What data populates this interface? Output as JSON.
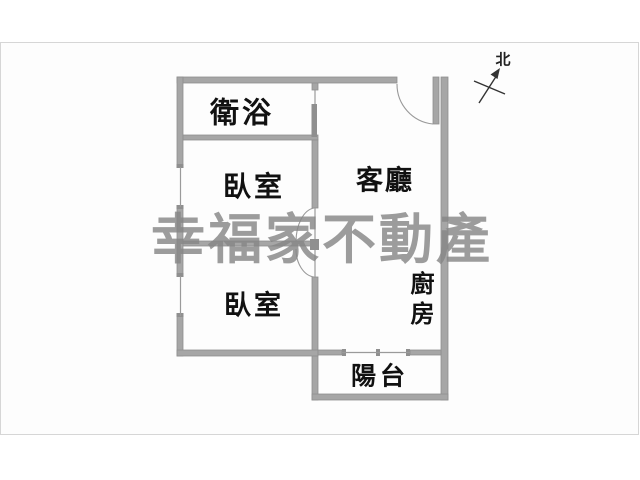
{
  "meta": {
    "kind": "real-estate floor plan image",
    "canvas_bg": "#ffffff",
    "frame_border": "#d6d6d6",
    "frame_bg": "#fdfdfd"
  },
  "watermark": {
    "text": "幸福家不動產",
    "color": "#868686"
  },
  "compass": {
    "label": "北"
  },
  "rooms": [
    {
      "id": "bathroom",
      "label": "衛浴"
    },
    {
      "id": "bedroom-1",
      "label": "臥室"
    },
    {
      "id": "living-room",
      "label": "客廳"
    },
    {
      "id": "bedroom-2",
      "label": "臥室"
    },
    {
      "id": "kitchen",
      "label": "廚房",
      "orientation": "vertical"
    },
    {
      "id": "balcony",
      "label": "陽台"
    }
  ],
  "colors": {
    "wall_fill": "#a6a6a6",
    "wall_edge": "#8f8f8f",
    "door_line": "#999999",
    "window_line": "#9a9a9a",
    "label_text": "#111111",
    "compass_line": "#333333"
  }
}
